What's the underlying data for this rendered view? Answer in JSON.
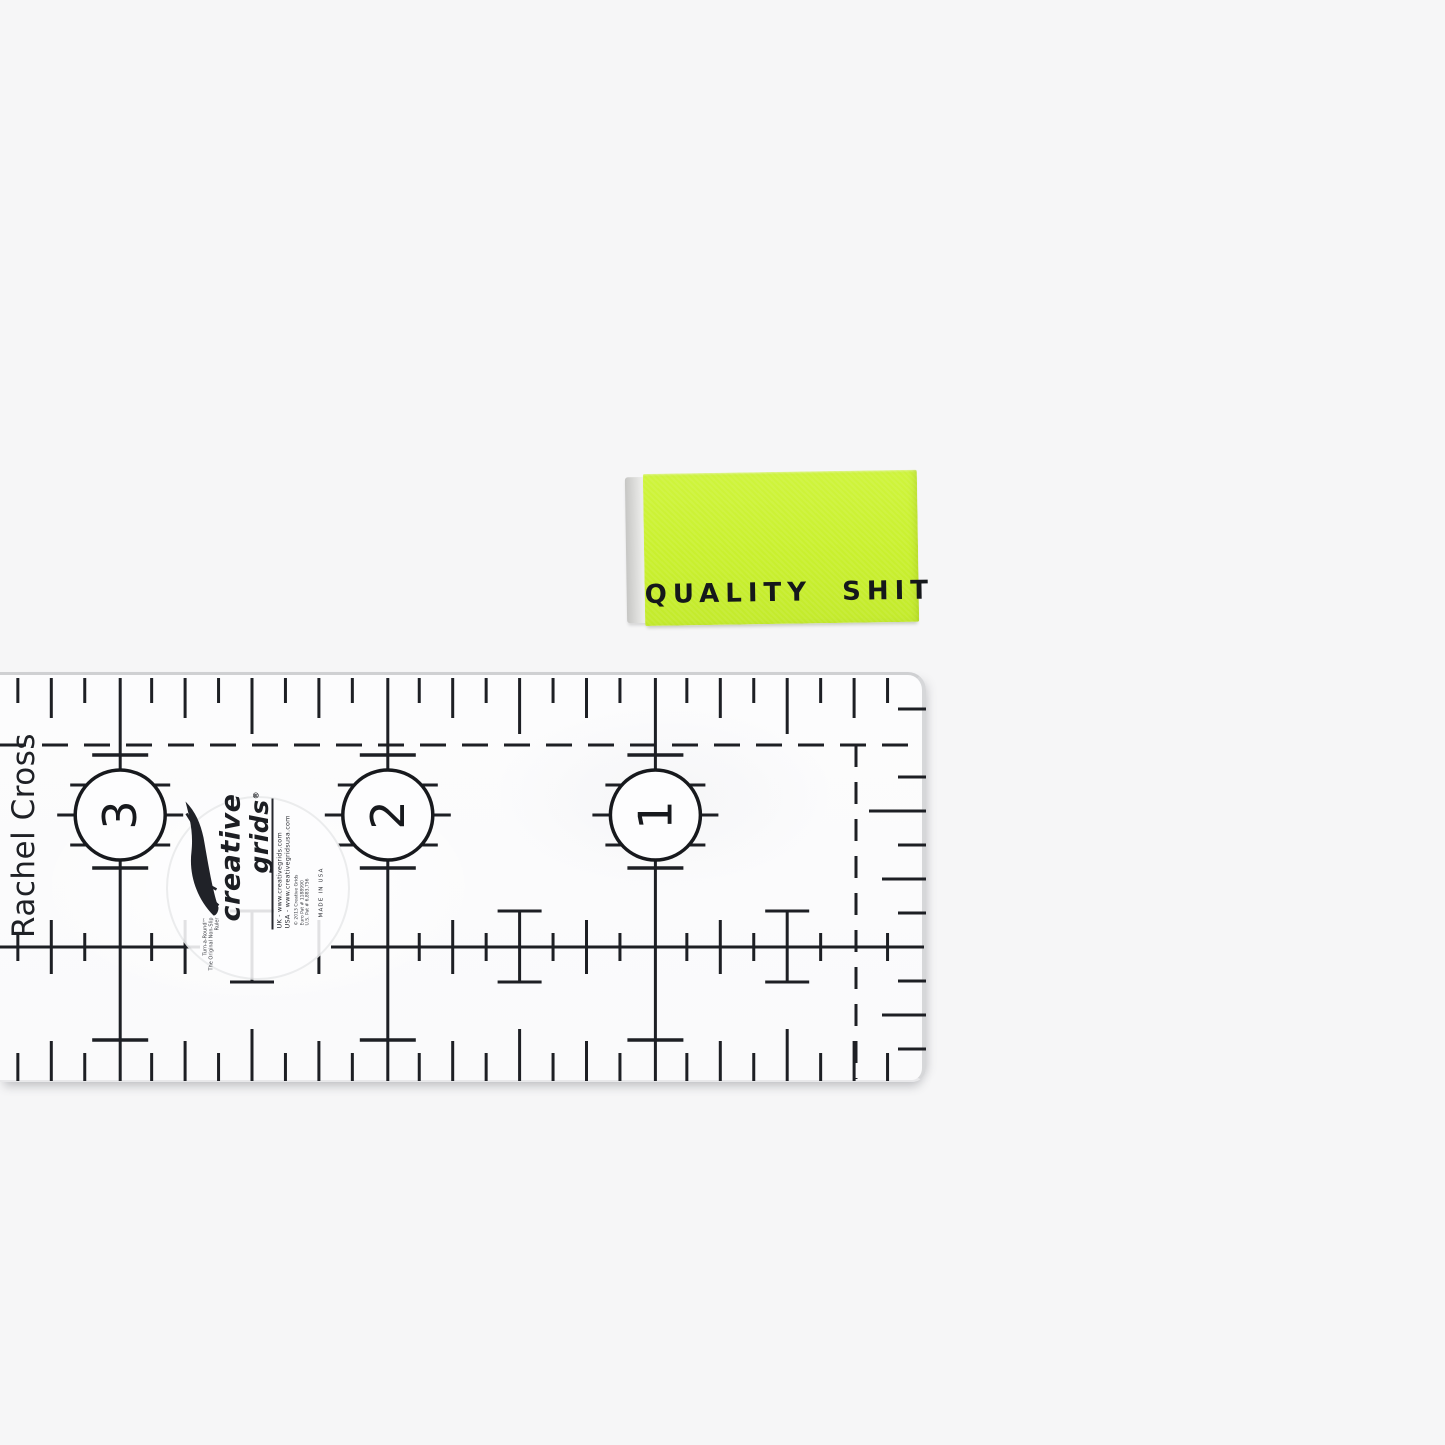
{
  "scene": {
    "background_color": "#f6f6f7",
    "ink_color": "#1d1f24"
  },
  "label": {
    "text": "QUALITY SHIT",
    "fabric_color": "#c9f02e",
    "text_color": "#15181b"
  },
  "ruler": {
    "handwritten_name": "Rachel Cross",
    "inch_numbers": [
      "3",
      "2",
      "1"
    ],
    "logo": {
      "tagline_1": "Turn-a-Round™",
      "tagline_2": "The Original Non-Slip Ruler",
      "brand_word_1": "creative",
      "brand_word_2": "grids",
      "registered": "®",
      "uk_site": "UK - www.creativegrids.com",
      "usa_site": "USA - www.creativegridsusa.com",
      "copyright": "© 2013 Creative Grids",
      "pat_1": "Euro Pat # 1188990",
      "pat_2": "U.S. Pat # 6,883,756",
      "made_in": "MADE IN USA"
    }
  }
}
